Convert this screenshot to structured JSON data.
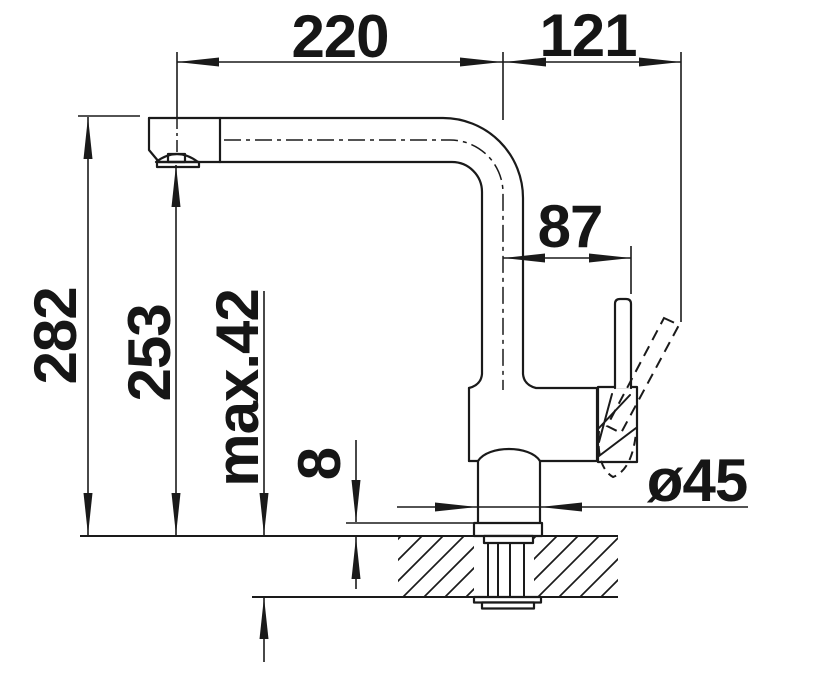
{
  "title": "Kitchen faucet dimension drawing",
  "colors": {
    "line": "#1a1a1a",
    "text": "#161616",
    "background": "#ffffff"
  },
  "dimensions": {
    "spout_reach": "220",
    "handle_tip_offset": "121",
    "handle_axis_offset": "87",
    "overall_height": "282",
    "outlet_height": "253",
    "max_mount_thickness": "max.42",
    "base_plate_height": "8",
    "base_diameter": "ø45"
  }
}
